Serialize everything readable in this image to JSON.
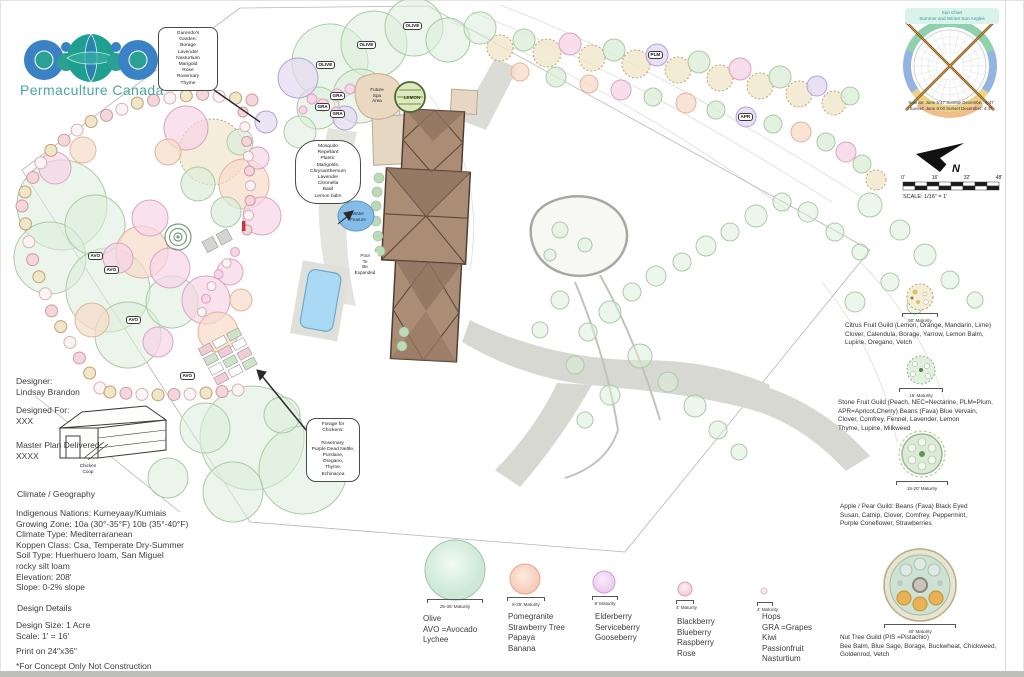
{
  "brand": {
    "name": "Permaculture Canada"
  },
  "meta": {
    "designer_label": "Designer:",
    "designer_name": "Lindsay Brandon",
    "designed_for_label": "Designed For:",
    "designed_for_value": "XXX",
    "delivered_label": "Master Plan Delivered:",
    "delivered_value": "XXXX"
  },
  "climate": {
    "title": "Climate / Geography",
    "body": "Indigenous Nations: Kumeyaay/Kumiais\nGrowing Zone: 10a (30°-35°F) 10b (35°-40°F)\nClimate Type: Mediterraranean\nKoppen Class: Csa, Temperate Dry-Summer\nSoil Type: Huerhuero loam, San Miguel\nrocky silt loam\nElevation: 208'\nSlope: 0-2% slope"
  },
  "details": {
    "title": "Design Details",
    "body": "Design Size: 1 Acre\nScale: 1' = 16'",
    "print": "Print on 24\"x36\"",
    "disclaimer": "*For Concept Only Not Construction"
  },
  "legend": {
    "items": [
      {
        "maturity": "25-35' Maturity",
        "species": "Olive\nAVO =Avocado\nLychee",
        "color": "#cde9d6"
      },
      {
        "maturity": "8-25' Maturity",
        "species": "Pomegranite\nStrawberry Tree\nPapaya\nBanana",
        "color": "#f6cdb9"
      },
      {
        "maturity": "8' Maturity",
        "species": "Elderberry\nServiceberry\nGooseberry",
        "color": "#eccdf0"
      },
      {
        "maturity": "4' Maturity",
        "species": "Blackberry\nBlueberry\nRaspberry\nRose",
        "color": "#f3cede"
      },
      {
        "maturity": "4' Maturity",
        "species": "Hops\nGRA =Grapes\nKiwi\nPassionfruit\nNasturtium",
        "color": "#f5e8ef"
      }
    ]
  },
  "guilds": [
    {
      "maturity": "50' Maturity",
      "text": "Citrus Fruit Guild (Lemon, Orange, Mandarin, Lime)\nClover, Calendula, Borage, Yarrow, Lemon Balm,\nLupine, Oregano, Vetch"
    },
    {
      "maturity": "15' Maturity",
      "text": "Stone Fruit Guild (Peach, NEC=Nectarine, PLM=Plum,\nAPR=Apricot,Cherry) Beans (Fava) Blue Vervain,\nClover, Comfrey, Fennel, Lavender, Lemon\nThyme, Lupine, Milkweed"
    },
    {
      "maturity": "15-20' Maturity",
      "text": "Apple / Pear Guild: Beans (Fava) Black Eyed\nSusan, Catnip, Clover, Comfrey, Peppermint,\nPurple Coneflower, Strawberries"
    },
    {
      "maturity": "40' Maturity",
      "text": "Nut Tree Guild (PIS =Pistachio)\nBee Balm, Blue Sage, Borage, Buckwheat, Chickweed,\nGoldenrod, Vetch"
    }
  ],
  "sun": {
    "header": "Sun Chart\nSummer and Winter Sun Angles",
    "captions": "Sunrise: June 5:47   Sunrise December: 6:47\nSunset: June 8:00   Sunset December: 4:47"
  },
  "scale": {
    "north": "N",
    "ticks": [
      "0'",
      "16'",
      "32'",
      "48'"
    ],
    "caption": "SCALE: 1/16\" = 1'"
  },
  "plan": {
    "callouts": {
      "gurendo": "Gurendo's\nGarden:\nBorage\nLavender\nNasturtium\nMarigold\nRose\nRosemary\nThyme",
      "mosquito": "Mosquito\nRepellant\nPlants:\nMarigolds,\nChrysanthemum\nLavender\nCitronella\nBasil\nLemon balm",
      "forage": "Forage for\nChickens:\n\nRosemary,\nPurple Dead Nettle,\nPurslane,\nOregano,\nThyme,\nEchinacea"
    },
    "notes": {
      "water": "Water\nFeature",
      "pool": "Pool\nTo\nBe\nExpanded",
      "spa": "Future\nSpa\nArea",
      "lemon": "LEMON",
      "coop": "Chicken\nCoop"
    },
    "pills": {
      "olive": "OLIVE",
      "gra": "GRA",
      "avo": "AVO",
      "plm": "PLM",
      "apr": "APR"
    }
  },
  "colors": {
    "brand_teal": "#2aa193",
    "brand_blue": "#3b82c4",
    "house": "#ab8d75",
    "pool": "#a9d9f4",
    "water_feature": "#85bce8",
    "canopy_green": "#dcedda",
    "path_gray": "#d8d8d3"
  }
}
